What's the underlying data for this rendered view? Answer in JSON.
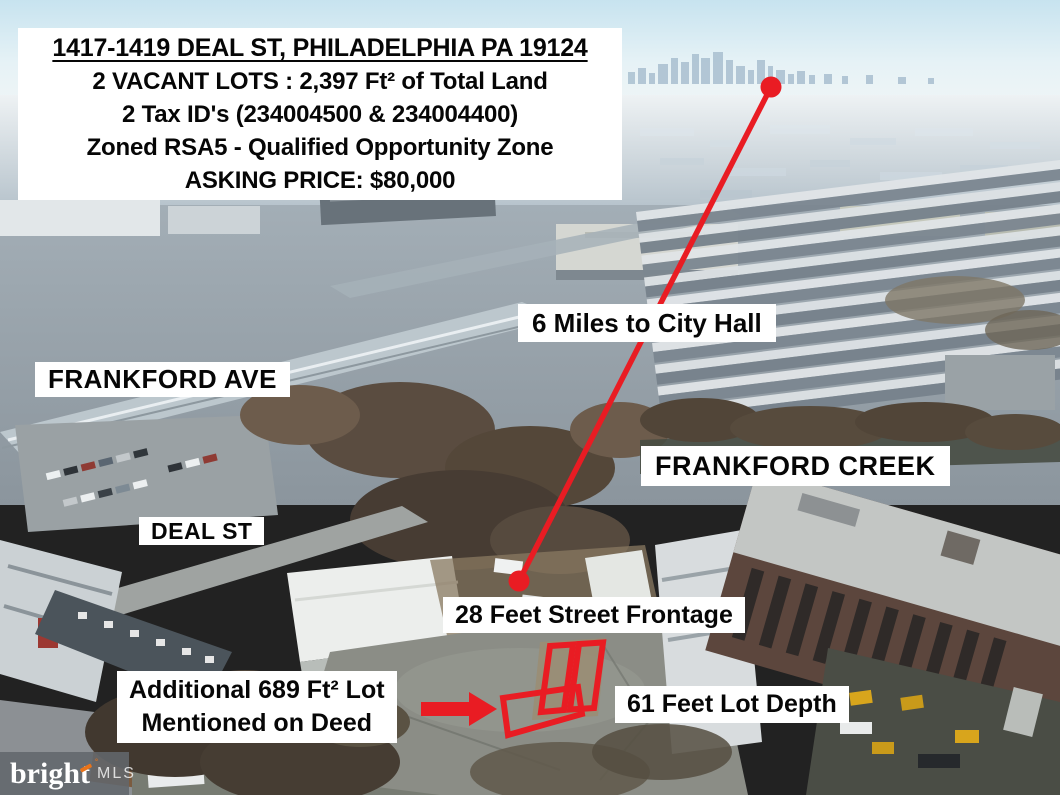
{
  "header": {
    "address": "1417-1419 DEAL ST, PHILADELPHIA PA 19124",
    "lots_line": "2 VACANT LOTS : 2,397 Ft² of Total Land",
    "tax_line": "2 Tax ID's (234004500 & 234004400)",
    "zoning_line": "Zoned RSA5 - Qualified Opportunity Zone",
    "price_line": "ASKING PRICE: $80,000"
  },
  "labels": {
    "city_hall_distance": "6 Miles to City Hall",
    "frankford_ave": "FRANKFORD AVE",
    "frankford_creek": "FRANKFORD CREEK",
    "deal_st": "DEAL ST",
    "street_frontage": "28 Feet Street Frontage",
    "additional_lot_line1": "Additional 689 Ft² Lot",
    "additional_lot_line2": "Mentioned on Deed",
    "lot_depth": "61 Feet Lot Depth"
  },
  "watermark": {
    "brand": "bright",
    "suffix": "MLS"
  },
  "colors": {
    "annotation_red": "#e91c23",
    "label_background": "#ffffff",
    "label_text": "#060606",
    "watermark_accent": "#e8731a"
  }
}
